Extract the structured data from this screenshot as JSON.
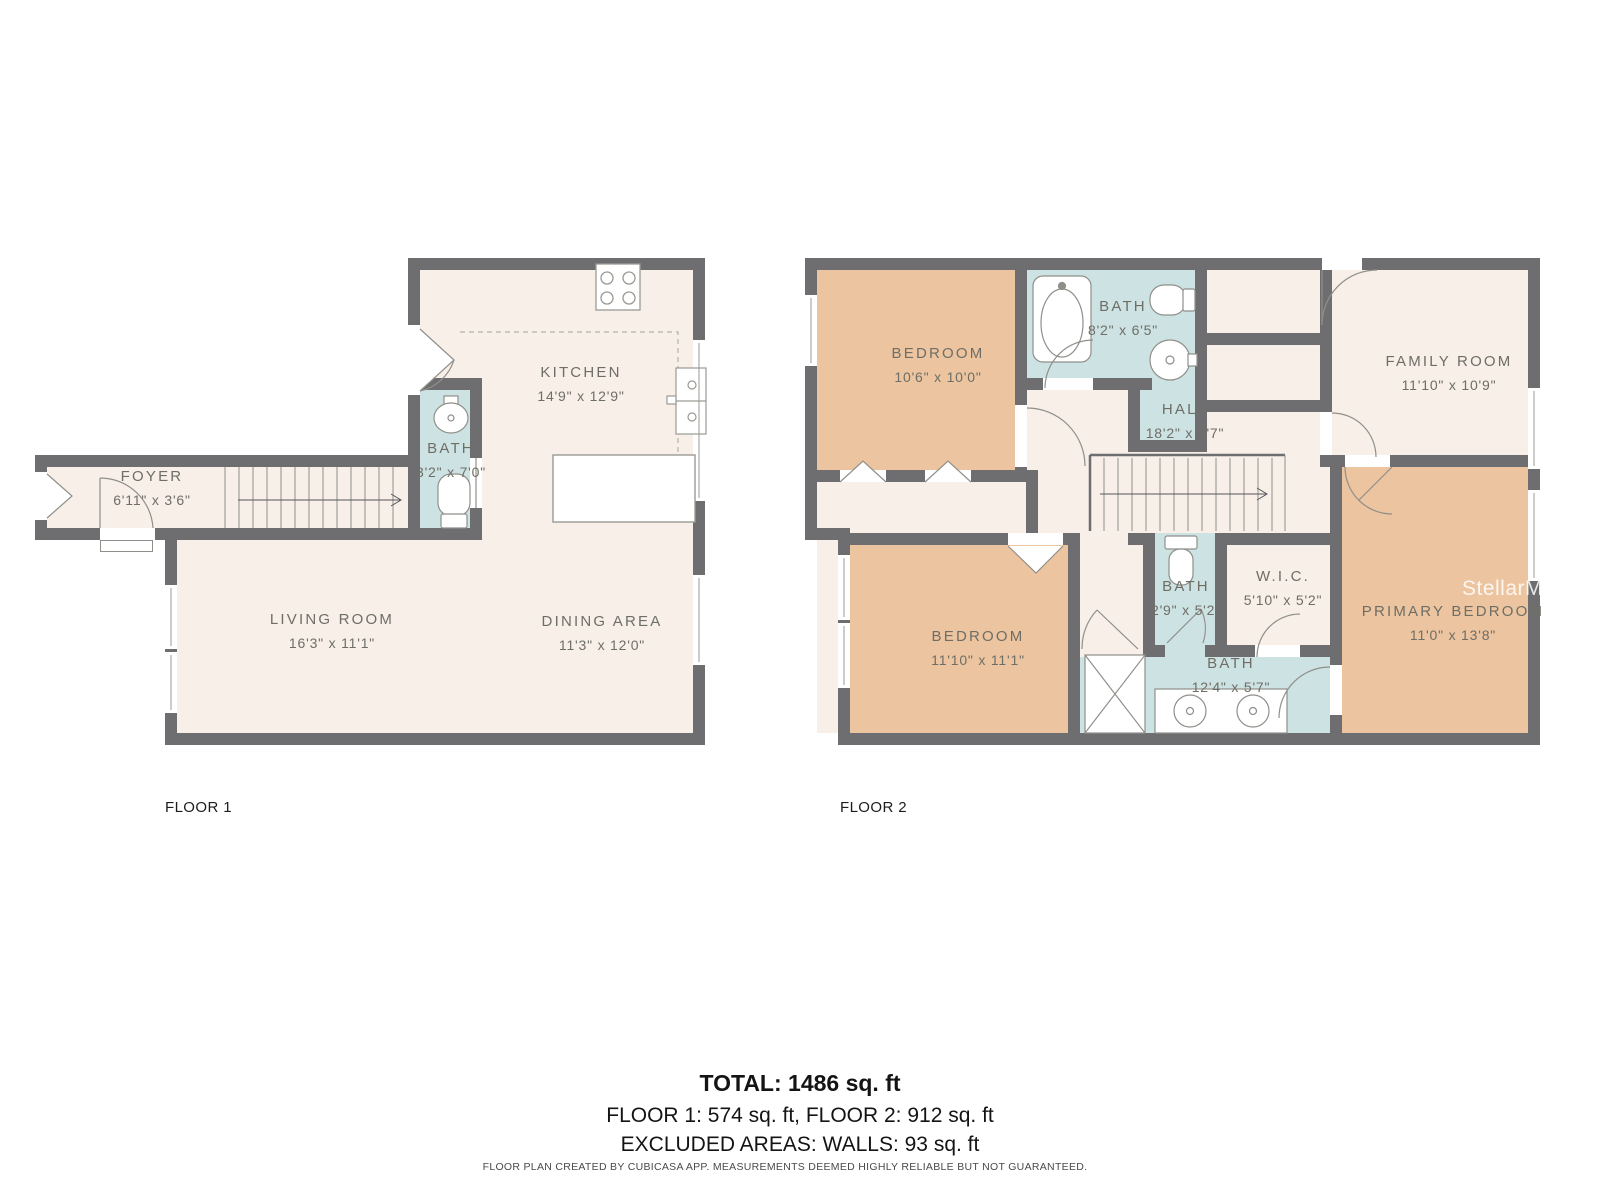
{
  "floor_plan": {
    "floors": [
      {
        "label": "FLOOR 1",
        "rooms": [
          {
            "name": "FOYER",
            "dims": "6'11\" x 3'6\""
          },
          {
            "name": "KITCHEN",
            "dims": "14'9\" x 12'9\""
          },
          {
            "name": "BATH",
            "dims": "3'2\" x 7'0\""
          },
          {
            "name": "LIVING ROOM",
            "dims": "16'3\" x 11'1\""
          },
          {
            "name": "DINING AREA",
            "dims": "11'3\" x 12'0\""
          }
        ]
      },
      {
        "label": "FLOOR 2",
        "rooms": [
          {
            "name": "BEDROOM",
            "dims": "10'6\" x 10'0\""
          },
          {
            "name": "BATH",
            "dims": "8'2\" x 6'5\""
          },
          {
            "name": "FAMILY ROOM",
            "dims": "11'10\" x 10'9\""
          },
          {
            "name": "HALL",
            "dims": "18'2\" x 6'7\""
          },
          {
            "name": "BEDROOM",
            "dims": "11'10\" x 11'1\""
          },
          {
            "name": "BATH",
            "dims": "2'9\" x 5'2\""
          },
          {
            "name": "W.I.C.",
            "dims": "5'10\" x 5'2\""
          },
          {
            "name": "BATH",
            "dims": "12'4\" x 5'7\""
          },
          {
            "name": "PRIMARY BEDROOM",
            "dims": "11'0\" x 13'8\""
          }
        ]
      }
    ],
    "summary": {
      "total": "TOTAL: 1486 sq. ft",
      "floors": "FLOOR 1: 574 sq. ft, FLOOR 2: 912 sq. ft",
      "excluded": "EXCLUDED AREAS: WALLS: 93 sq. ft"
    },
    "footer": "FLOOR PLAN CREATED BY CUBICASA APP. MEASUREMENTS DEEMED HIGHLY RELIABLE BUT NOT GUARANTEED.",
    "watermark": "StellarMLS",
    "colors": {
      "wall": "#6e6e70",
      "floor": "#f7efe8",
      "bedroom": "#ecc49f",
      "bath": "#cde2e2"
    }
  }
}
